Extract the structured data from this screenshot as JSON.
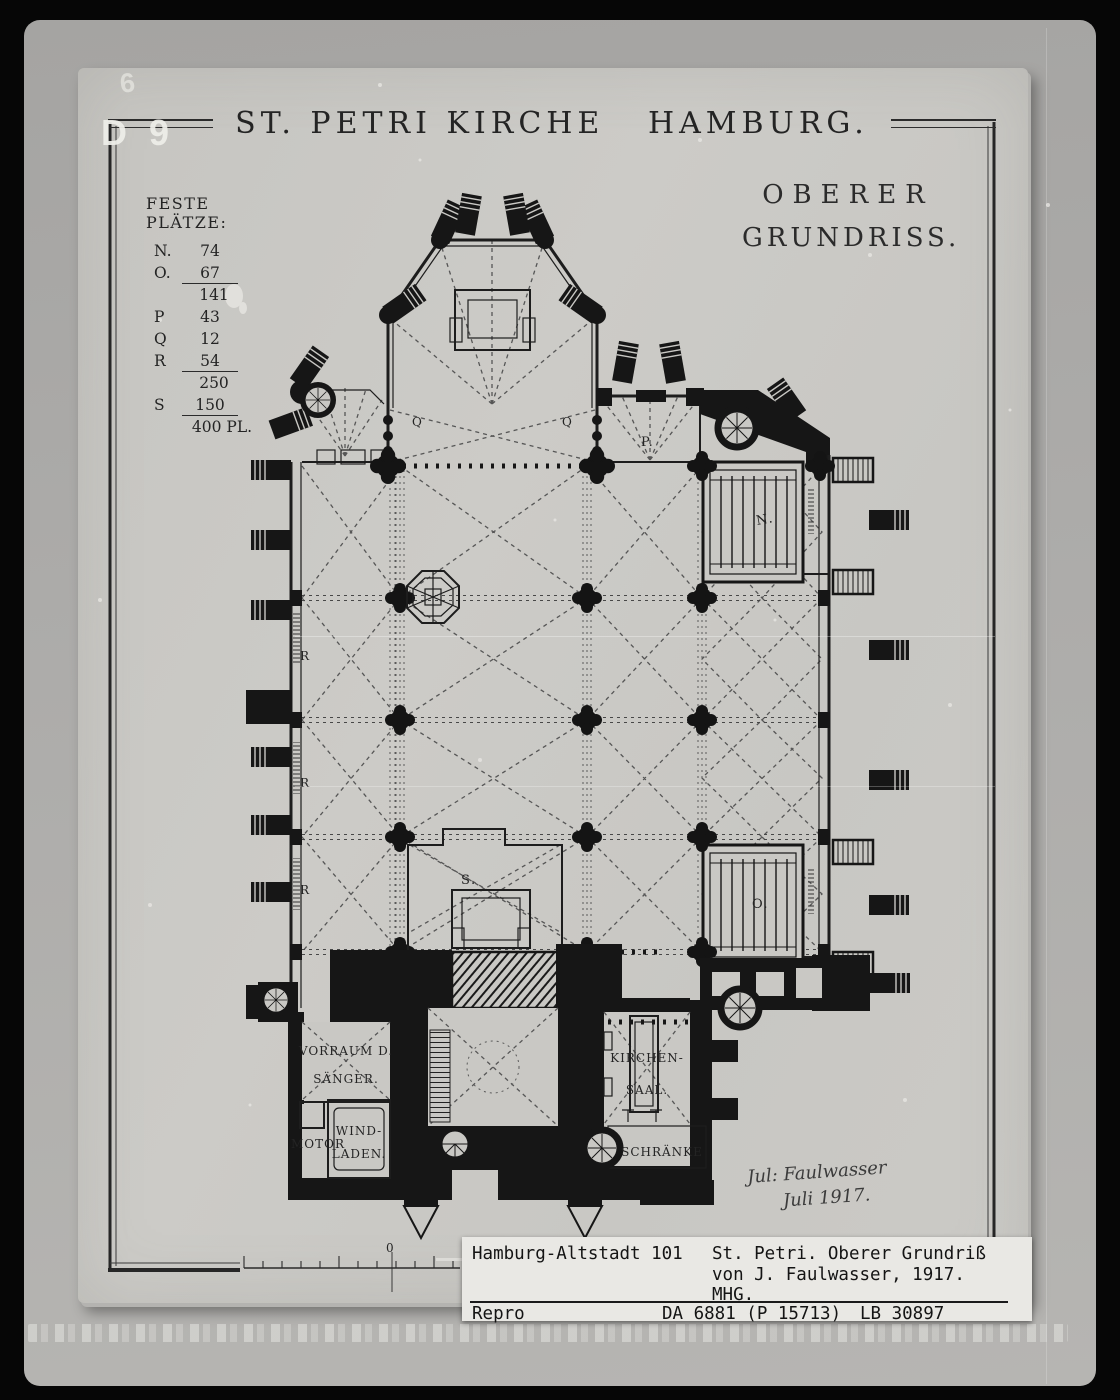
{
  "photo": {
    "corner_mark_top": "6",
    "corner_mark_side": "D 9"
  },
  "title": "ST. PETRI KIRCHE   HAMBURG.",
  "heading": {
    "line1": "OBERER",
    "line2": "GRUNDRISS."
  },
  "seats": {
    "heading": "FESTE PLÄTZE:",
    "rows": [
      {
        "label": "N.",
        "value": "74"
      },
      {
        "label": "O.",
        "value": "67"
      },
      {
        "label": "",
        "value": "141"
      },
      {
        "label": "P",
        "value": "43"
      },
      {
        "label": "Q",
        "value": "12"
      },
      {
        "label": "R",
        "value": "54"
      },
      {
        "label": "",
        "value": "250"
      },
      {
        "label": "S",
        "value": "150"
      },
      {
        "label": "",
        "value": "400 PL."
      }
    ]
  },
  "plan_labels": {
    "chapel_p": "P.",
    "gallery_n": "N.",
    "gallery_o": "O.",
    "organ_s": "S.",
    "choir_q_left": "Q",
    "choir_q_right": "Q",
    "aisle_r": [
      "R",
      "R",
      "R"
    ],
    "vorraum_line1": "VORRAUM D.",
    "vorraum_line2": "SÄNGER.",
    "motor": "MOTOR",
    "windladen_line1": "WIND-",
    "windladen_line2": "LADEN.",
    "kirchensaal_line1": "KIRCHEN-",
    "kirchensaal_line2": "SAAL.",
    "schraenke": "SCHRÄNKE",
    "scale_zero": "0"
  },
  "signature": {
    "line1": "Jul: Faulwasser",
    "line2": "Juli 1917."
  },
  "archive_label": {
    "location": "Hamburg-Altstadt 101",
    "title_line1": "St. Petri. Oberer Grundriß",
    "title_line2": "von J. Faulwasser, 1917.",
    "title_line3": "MHG.",
    "repro": "Repro",
    "number": "DA 6881 (P 15713)",
    "lb_number": "LB 30897"
  },
  "colors": {
    "frame": "#060606",
    "mount": "#aaa9a6",
    "sheet": "#c9c8c4",
    "ink": "#1c1c1c",
    "label_bg": "#e9e8e4"
  }
}
